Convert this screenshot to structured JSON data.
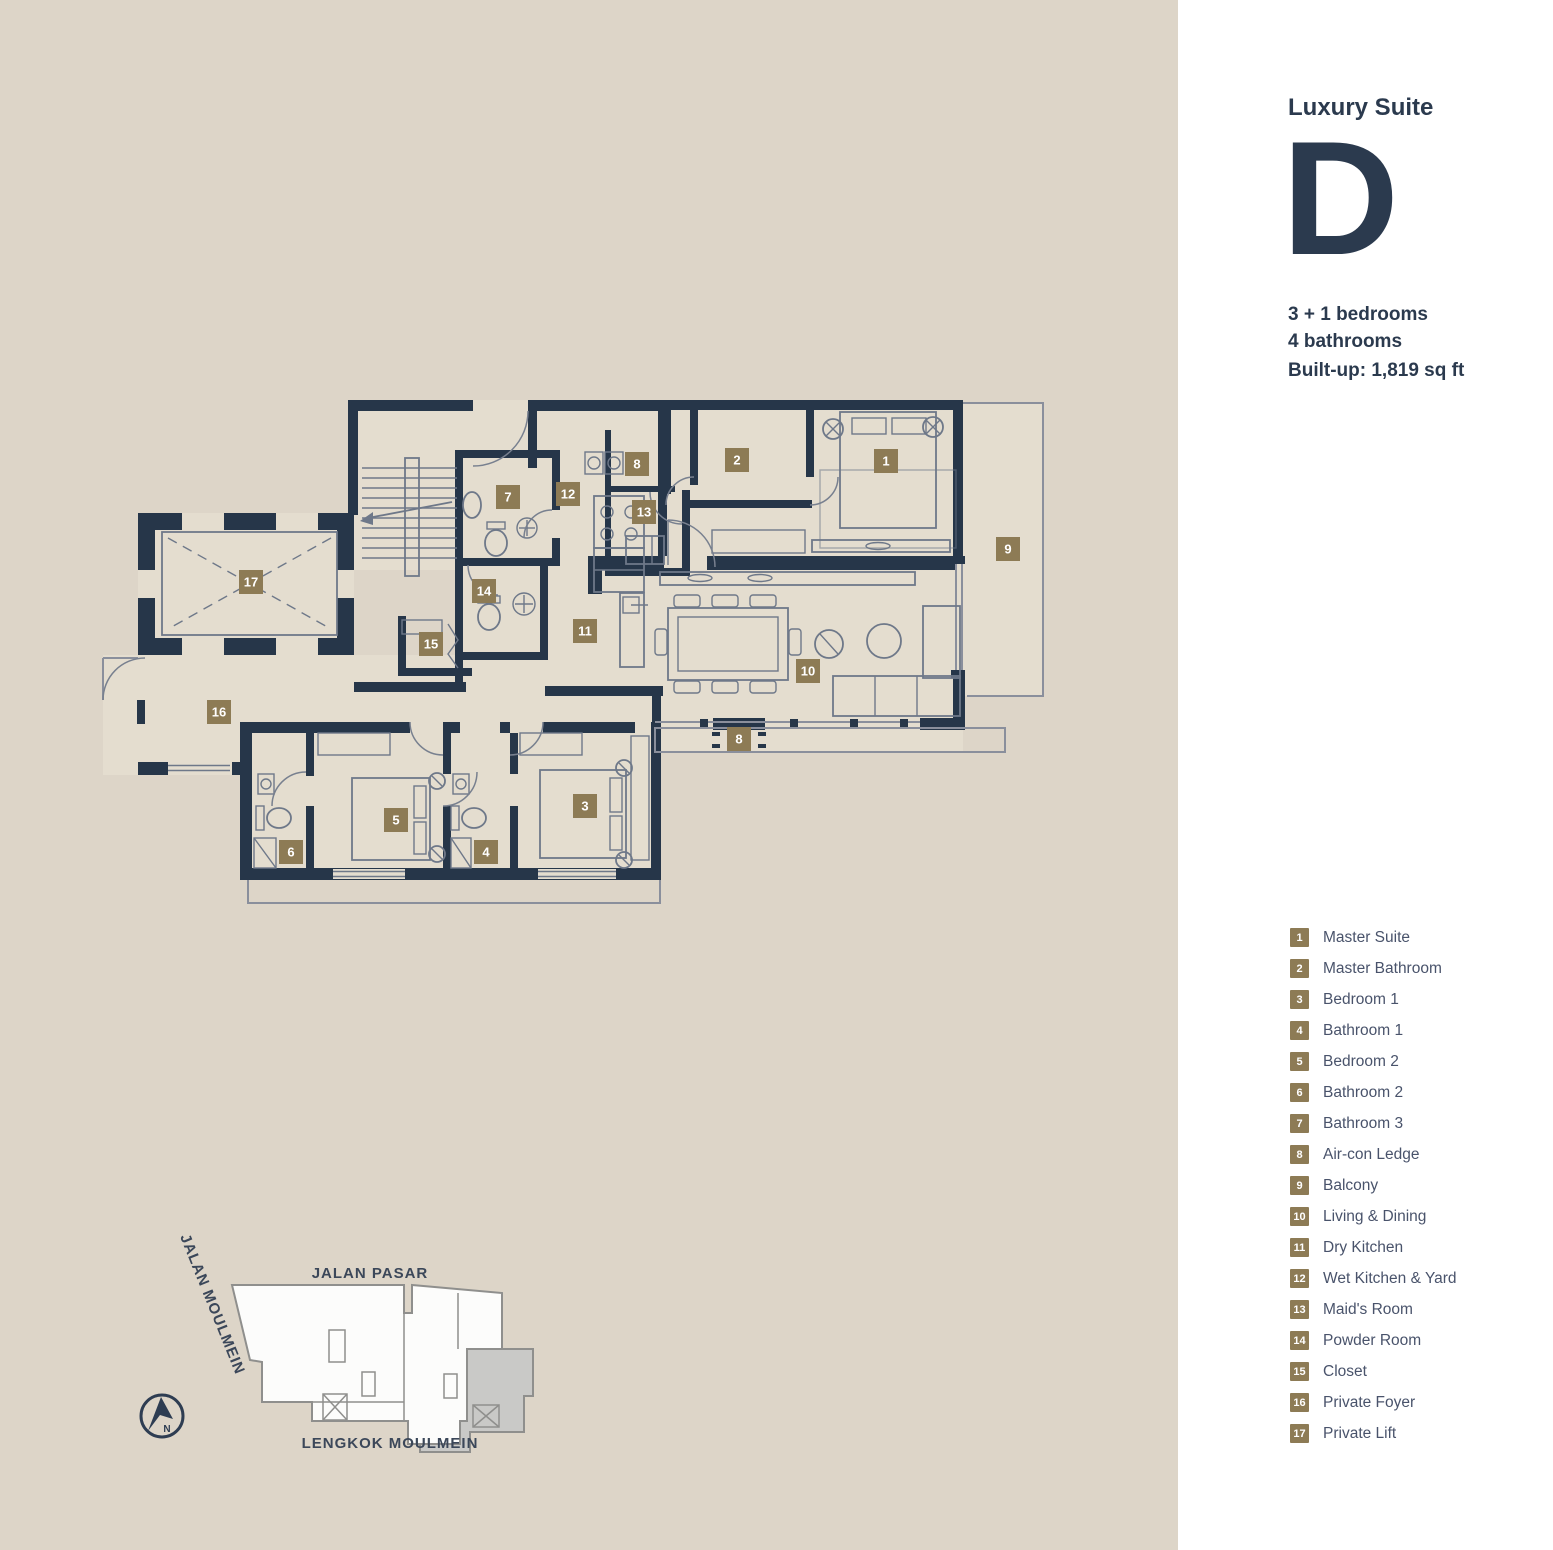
{
  "panel": {
    "title": "Luxury Suite",
    "unit_letter": "D",
    "bedrooms": "3 + 1 bedrooms",
    "bathrooms": "4 bathrooms",
    "built_up": "Built-up: 1,819 sq ft"
  },
  "legend": {
    "items": [
      {
        "num": "1",
        "label": "Master Suite"
      },
      {
        "num": "2",
        "label": "Master Bathroom"
      },
      {
        "num": "3",
        "label": "Bedroom 1"
      },
      {
        "num": "4",
        "label": "Bathroom 1"
      },
      {
        "num": "5",
        "label": "Bedroom 2"
      },
      {
        "num": "6",
        "label": "Bathroom 2"
      },
      {
        "num": "7",
        "label": "Bathroom 3"
      },
      {
        "num": "8",
        "label": "Air-con Ledge"
      },
      {
        "num": "9",
        "label": "Balcony"
      },
      {
        "num": "10",
        "label": "Living & Dining"
      },
      {
        "num": "11",
        "label": "Dry Kitchen"
      },
      {
        "num": "12",
        "label": "Wet Kitchen & Yard"
      },
      {
        "num": "13",
        "label": "Maid's Room"
      },
      {
        "num": "14",
        "label": "Powder Room"
      },
      {
        "num": "15",
        "label": "Closet"
      },
      {
        "num": "16",
        "label": "Private Foyer"
      },
      {
        "num": "17",
        "label": "Private Lift"
      }
    ]
  },
  "site_plan": {
    "street_top": "JALAN PASAR",
    "street_left": "JALAN MOULMEIN",
    "street_bottom": "LENGKOK MOULMEIN",
    "north_label": "N"
  },
  "colors": {
    "background_beige": "#ddd5c8",
    "floor_fill": "#e4ddcf",
    "wall_navy": "#263649",
    "badge_olive": "#8d7b55",
    "text_navy": "#2b3a4e",
    "legend_text": "#49536b",
    "site_outline_gray": "#8f8f8d",
    "unit_highlight_gray": "#c9c9c7"
  }
}
